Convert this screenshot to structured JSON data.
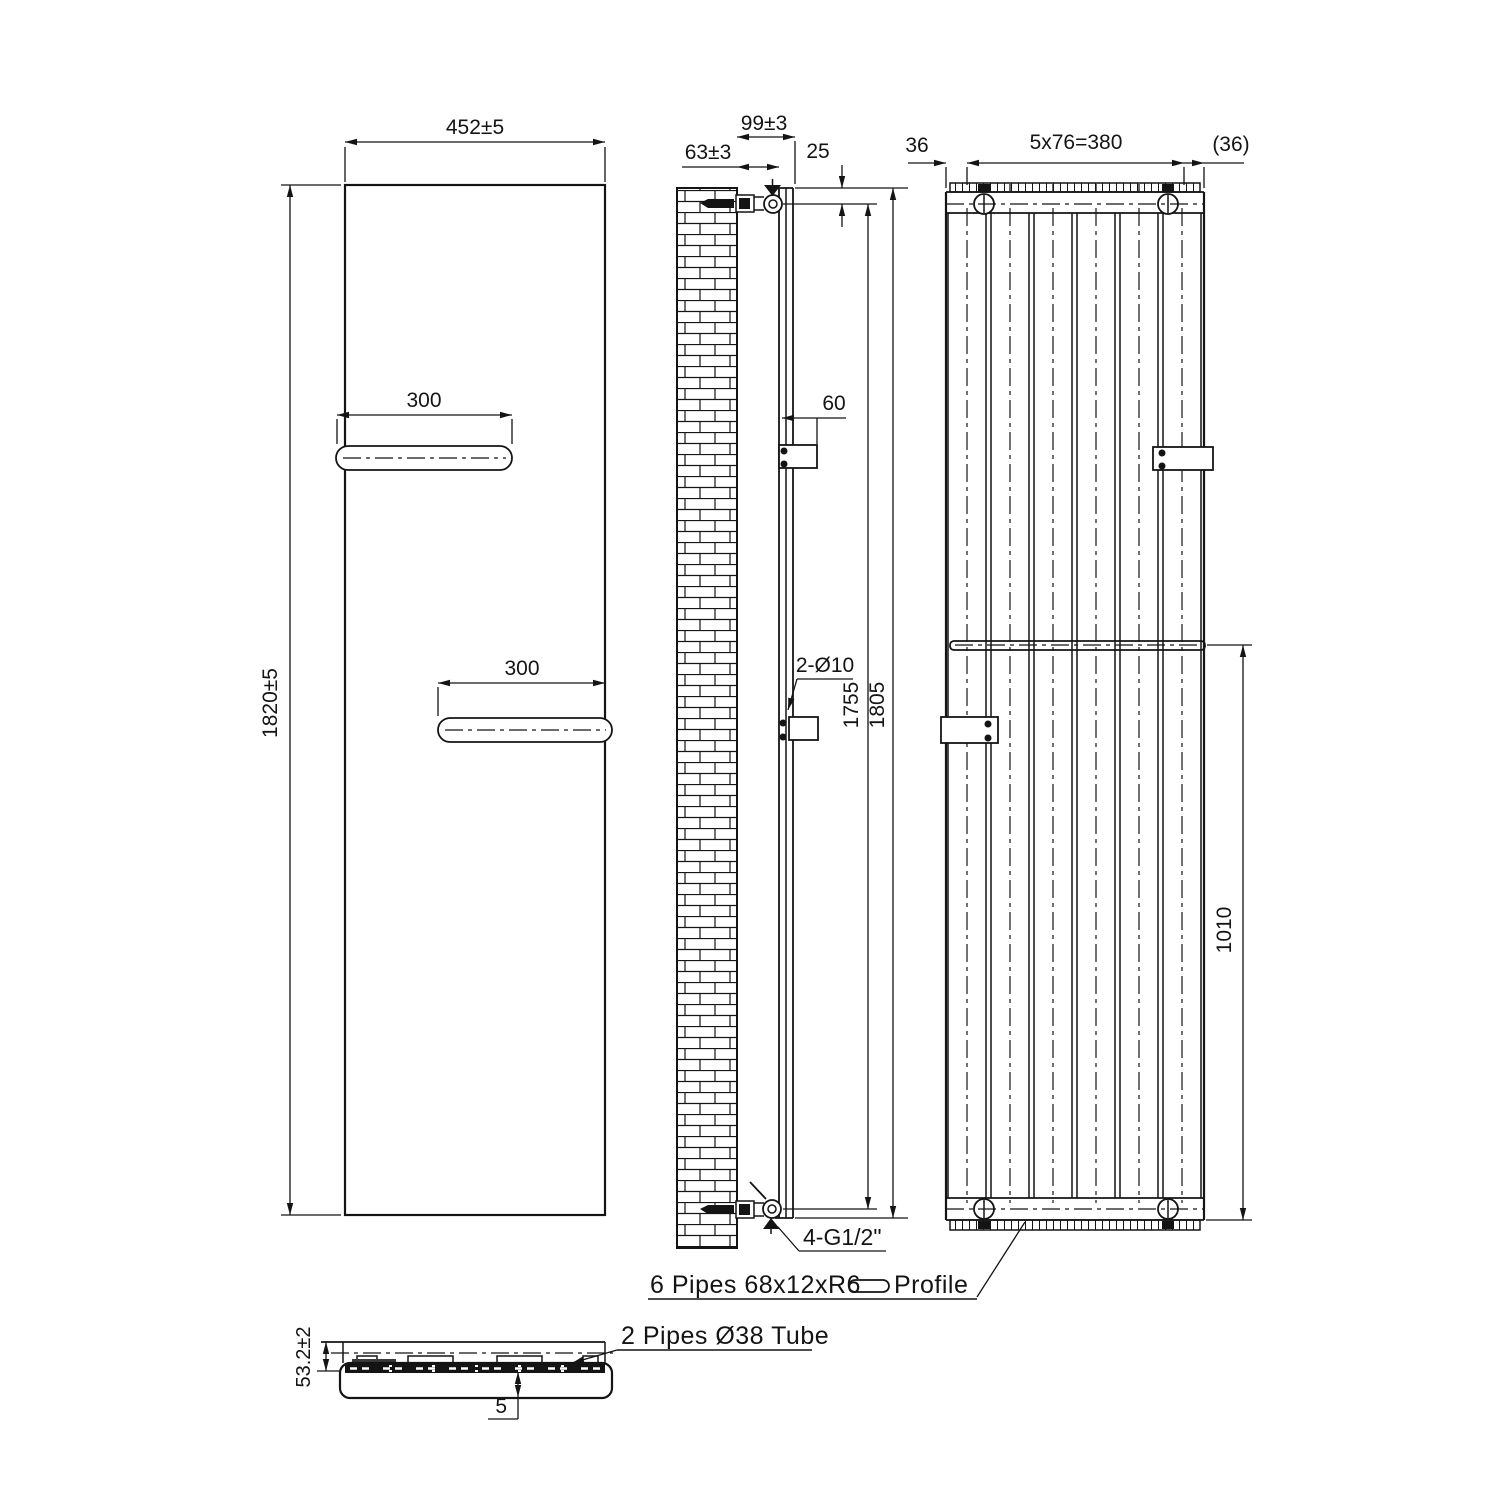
{
  "drawing": {
    "front_view": {
      "width_dim": "452±5",
      "height_dim": "1820±5",
      "shelf_top_dim": "300",
      "shelf_bottom_dim": "300"
    },
    "side_view": {
      "wall_to_back_dim": "63±3",
      "wall_to_front_dim": "99±3",
      "top_offset_dim": "25",
      "bracket_dim": "60",
      "holes_label": "2-Ø10",
      "pipe_centers_dim": "1755",
      "overall_height_dim": "1805",
      "connections_label": "4-G1/2\""
    },
    "rear_view": {
      "left_edge_dim": "36",
      "pipe_pitch_dim": "5x76=380",
      "right_edge_dim": "(36)",
      "shelf_to_bottom_dim": "1010"
    },
    "section_view": {
      "depth_dim": "53.2±2",
      "gap_dim": "5"
    },
    "notes": {
      "profile_note": "6 Pipes 68x12xR6",
      "profile_note_suffix": "Profile",
      "tube_note": "2 Pipes Ø38 Tube"
    }
  }
}
